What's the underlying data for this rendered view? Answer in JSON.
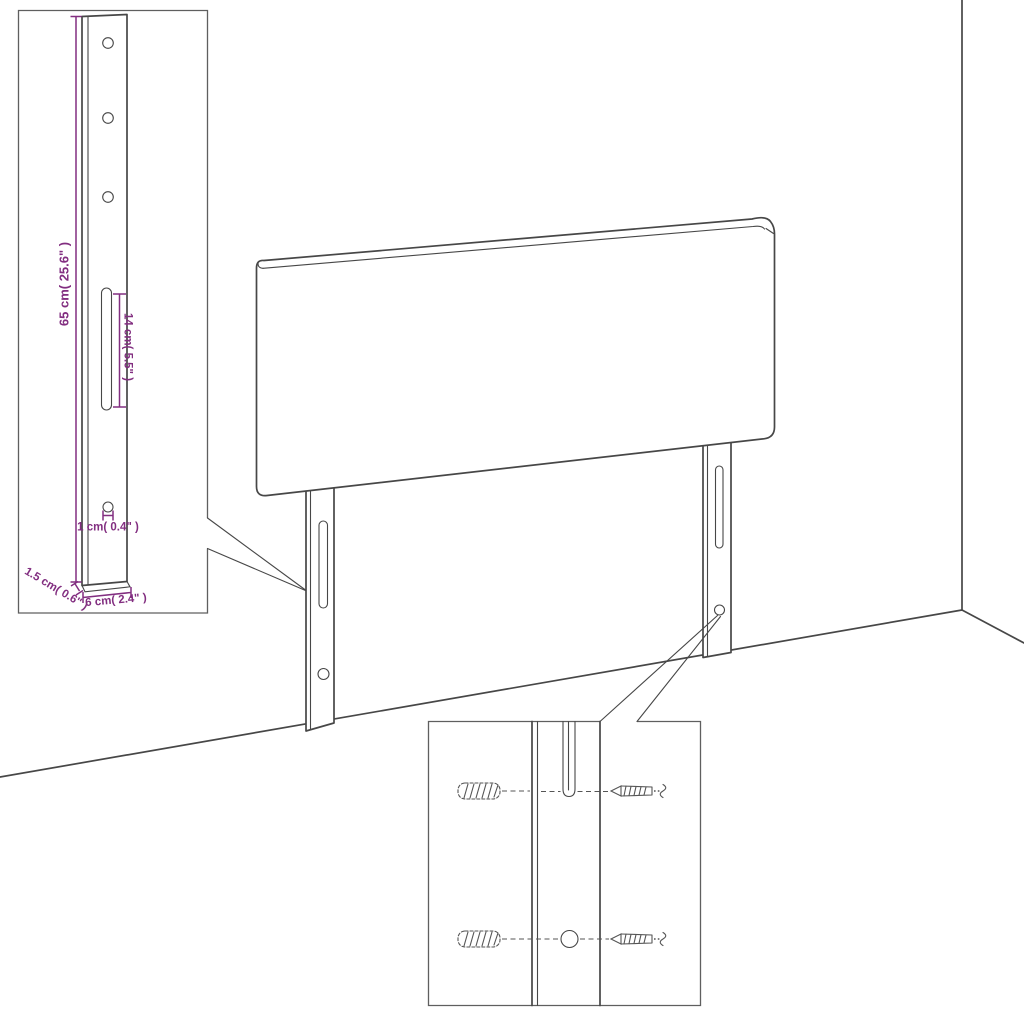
{
  "colors": {
    "dimension_accent": "#822e80",
    "line_color": "#474747",
    "inset_border_color": "#5f5f5f",
    "background": "#ffffff"
  },
  "dimensions": {
    "leg_height": "65 cm( 25.6\" )",
    "slot_length": "14 cm( 5.5\" )",
    "hole_diameter": "1 cm( 0.4\" )",
    "leg_width": "6 cm( 2.4\" )",
    "leg_thickness": "1.5 cm( 0.6\" )"
  }
}
